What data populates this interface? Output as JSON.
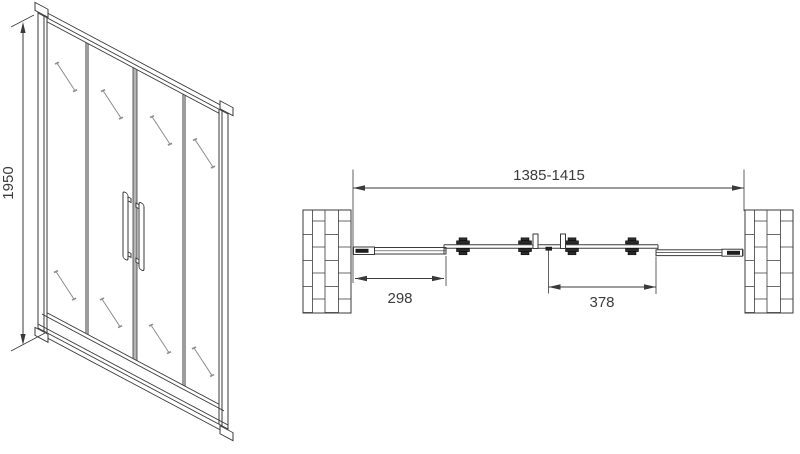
{
  "drawing": {
    "type": "technical-diagram",
    "subject": "sliding shower door, front elevation and plan view",
    "front_view": {
      "height_dim_label": "1950"
    },
    "plan_view": {
      "overall_width_dim_label": "1385-1415",
      "left_fixed_panel_dim_label": "298",
      "sliding_door_dim_label": "378"
    },
    "colors": {
      "line": "#3a3a3a",
      "text": "#3c3c3c",
      "dark_fill": "#1e1e1e",
      "stile_gray": "#b5b5b5",
      "glass_mark": "#8f8f8f",
      "background": "#ffffff"
    }
  }
}
